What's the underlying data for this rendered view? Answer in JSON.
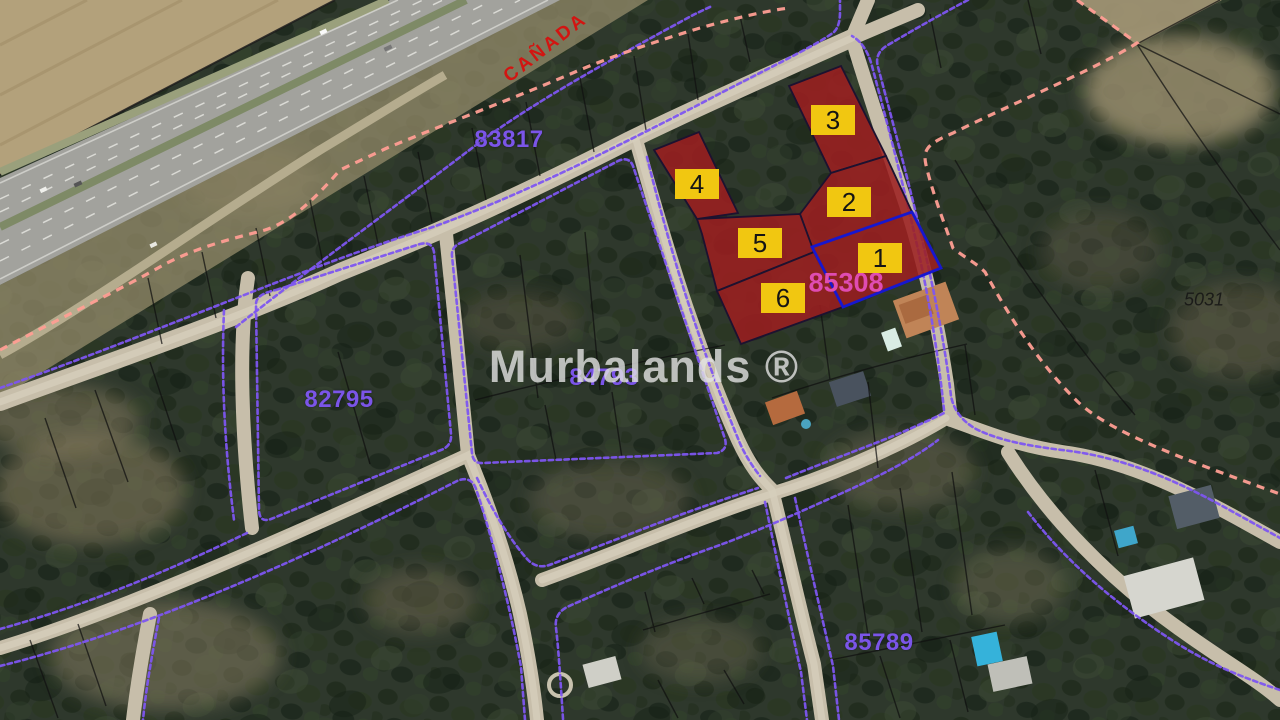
{
  "map": {
    "watermark": "Murbalands ®",
    "road_label": "CAÑADA",
    "parcel_labels": {
      "nw": "83817",
      "west": "82795",
      "center": "84793",
      "southeast": "85789"
    },
    "highlighted_parcel": {
      "id": "85308",
      "plots": [
        "1",
        "2",
        "3",
        "4",
        "5",
        "6"
      ]
    },
    "adjacent_parcel_id": "5031",
    "colors": {
      "boundary-purple": "#7d55f0",
      "boundary-pink": "#ff9e93",
      "plot-red": "#9c1f20",
      "plot-outline": "#1d1230",
      "selected-blue": "#1717cf",
      "chip-yellow": "#f1c711",
      "label-purple": "#7b55e8",
      "label-magenta": "#df4cb2",
      "label-red": "#d21511",
      "watermark-gray": "#e3e3e3"
    }
  }
}
